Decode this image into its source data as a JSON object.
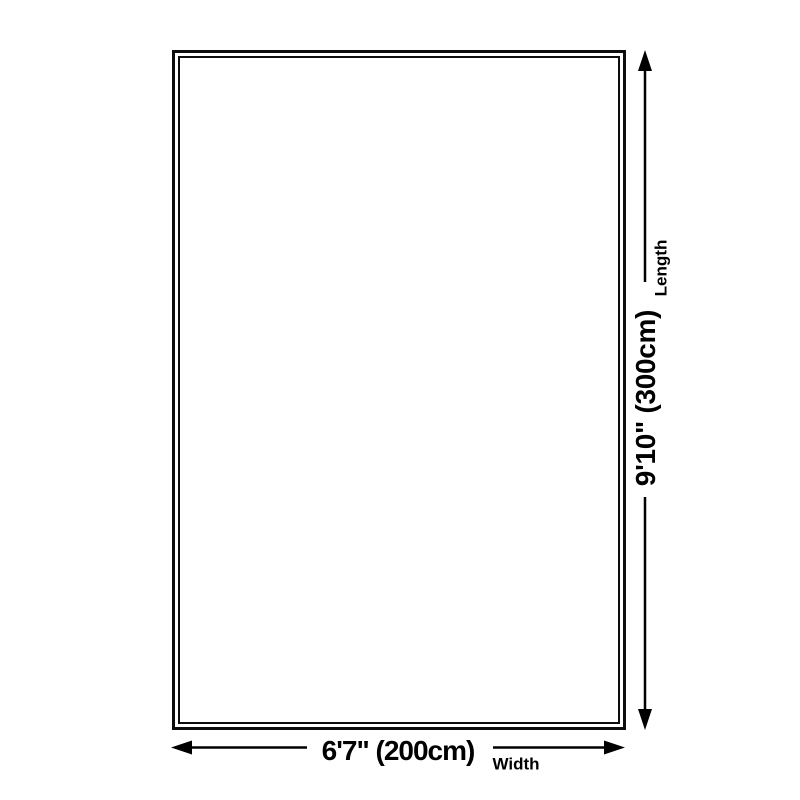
{
  "diagram": {
    "width_value": "6'7\" (200cm)",
    "width_label": "Width",
    "length_value": "9'10\" (300cm)",
    "length_label": "Length"
  },
  "colors": {
    "line": "#000000",
    "text": "#000000",
    "background": "#ffffff"
  }
}
